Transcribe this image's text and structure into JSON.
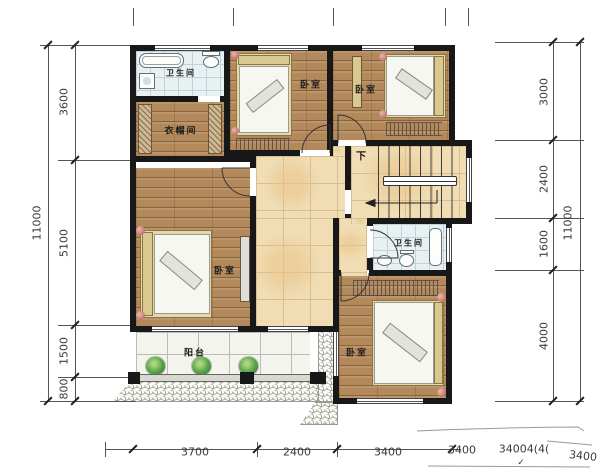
{
  "plan": {
    "rooms": {
      "bath_top": {
        "label": "卫生间"
      },
      "cloakroom": {
        "label": "衣帽间"
      },
      "bedroom_top_mid": {
        "label": "卧室"
      },
      "bedroom_top_right": {
        "label": "卧室"
      },
      "bedroom_left": {
        "label": "卧室"
      },
      "bath_mid": {
        "label": "卫生间"
      },
      "bedroom_bottom_right": {
        "label": "卧室"
      },
      "balcony": {
        "label": "阳台"
      },
      "stairs": {
        "direction_label": "下"
      }
    }
  },
  "dimensions": {
    "left": {
      "total": "11000",
      "segments": [
        "3600",
        "5100",
        "1500",
        "800"
      ]
    },
    "right": {
      "total": "11000",
      "segments": [
        "3000",
        "2400",
        "1600",
        "4000"
      ]
    },
    "bottom": {
      "segments": [
        "3700",
        "2400",
        "3400"
      ],
      "extra_labels": [
        "3400",
        "34004(4(",
        "3400"
      ],
      "artifact_mark": "✓"
    }
  },
  "colors": {
    "wall": "#181818",
    "wood_floor": "#b3895c",
    "bath_tile": "#e9f0f2",
    "hall_tile": "#f0ddb4",
    "balcony_tile": "#f4f4ee",
    "plant_green": "#57a049",
    "dimension_text": "#3a3a3a"
  }
}
